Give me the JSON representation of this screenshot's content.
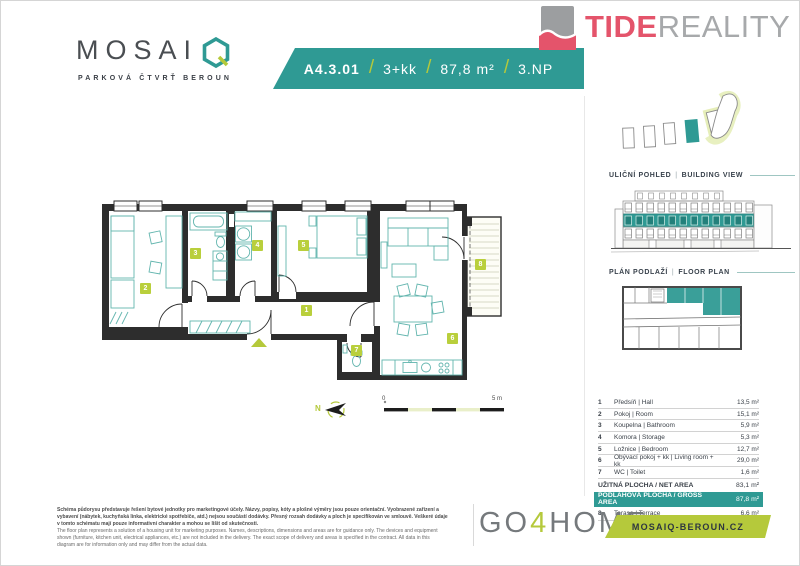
{
  "header": {
    "logo": {
      "brand": "MOSAI",
      "subtitle": "PARKOVÁ ČTVRŤ BEROUN"
    },
    "banner": {
      "unit": "A4.3.01",
      "layout": "3+kk",
      "area": "87,8 m²",
      "floor": "3.NP",
      "sep": "/"
    },
    "tide": {
      "part1": "TIDE",
      "part2": "REALITY"
    }
  },
  "sidebar": {
    "building_view": {
      "cz": "ULIČNÍ POHLED",
      "sep": "|",
      "en": "BUILDING VIEW"
    },
    "floor_plan": {
      "cz": "PLÁN PODLAŽÍ",
      "sep": "|",
      "en": "FLOOR PLAN"
    },
    "table": {
      "rooms": [
        {
          "num": "1",
          "name": "Předsíň | Hall",
          "area": "13,5 m²"
        },
        {
          "num": "2",
          "name": "Pokoj | Room",
          "area": "15,1 m²"
        },
        {
          "num": "3",
          "name": "Koupelna | Bathroom",
          "area": "5,9 m²"
        },
        {
          "num": "4",
          "name": "Komora | Storage",
          "area": "5,3 m²"
        },
        {
          "num": "5",
          "name": "Ložnice | Bedroom",
          "area": "12,7 m²"
        },
        {
          "num": "6",
          "name": "Obývací pokoj + kk | Living room + kk",
          "area": "29,0 m²"
        },
        {
          "num": "7",
          "name": "WC | Toilet",
          "area": "1,6 m²"
        }
      ],
      "net": {
        "label": "UŽITNÁ PLOCHA / NET AREA",
        "area": "83,1 m²"
      },
      "gross": {
        "label": "PODLAHOVÁ PLOCHA / GROSS AREA",
        "area": "87,8 m²"
      },
      "terrace": {
        "num": "8",
        "name": "Terasa | Terrace",
        "area": "6,6 m²"
      }
    }
  },
  "plan": {
    "room_labels": [
      "1",
      "2",
      "3",
      "4",
      "5",
      "6",
      "7",
      "8"
    ],
    "north": "N",
    "scale_zero": "0",
    "scale_end": "5 m"
  },
  "footer": {
    "disclaimer_cz": "Schéma půdorysu představuje řešení bytové jednotky pro marketingové účely. Názvy, popisy, kóty a plošné výměry jsou pouze orientační. Vyobrazené zařízení a vybavení (nábytek, kuchyňská linka, elektrické spotřebiče, atd.) nejsou součástí dodávky. Přesný rozsah dodávky a ploch je specifikován ve smlouvě. Veškeré údaje v tomto schématu mají pouze informativní charakter a mohou se lišit od skutečnosti.",
    "disclaimer_en": "The floor plan represents a solution of a housing unit for marketing purposes. Names, descriptions, dimensions and areas are for guidance only. The devices and equipment shown (furniture, kitchen unit, electrical appliances, etc.) are not included in the delivery. The exact scope of delivery and areas is specified in the contract. All data in this diagram are for information only and may differ from the actual data.",
    "gohome": {
      "go": "GO",
      "four": "4",
      "home": "HOME"
    },
    "website": "MOSAIQ-BEROUN.CZ"
  },
  "colors": {
    "teal": "#2f9a94",
    "olive": "#b5c93b",
    "pink": "#e4546b",
    "gray": "#a7a9ab",
    "wall": "#2d2d2d"
  }
}
